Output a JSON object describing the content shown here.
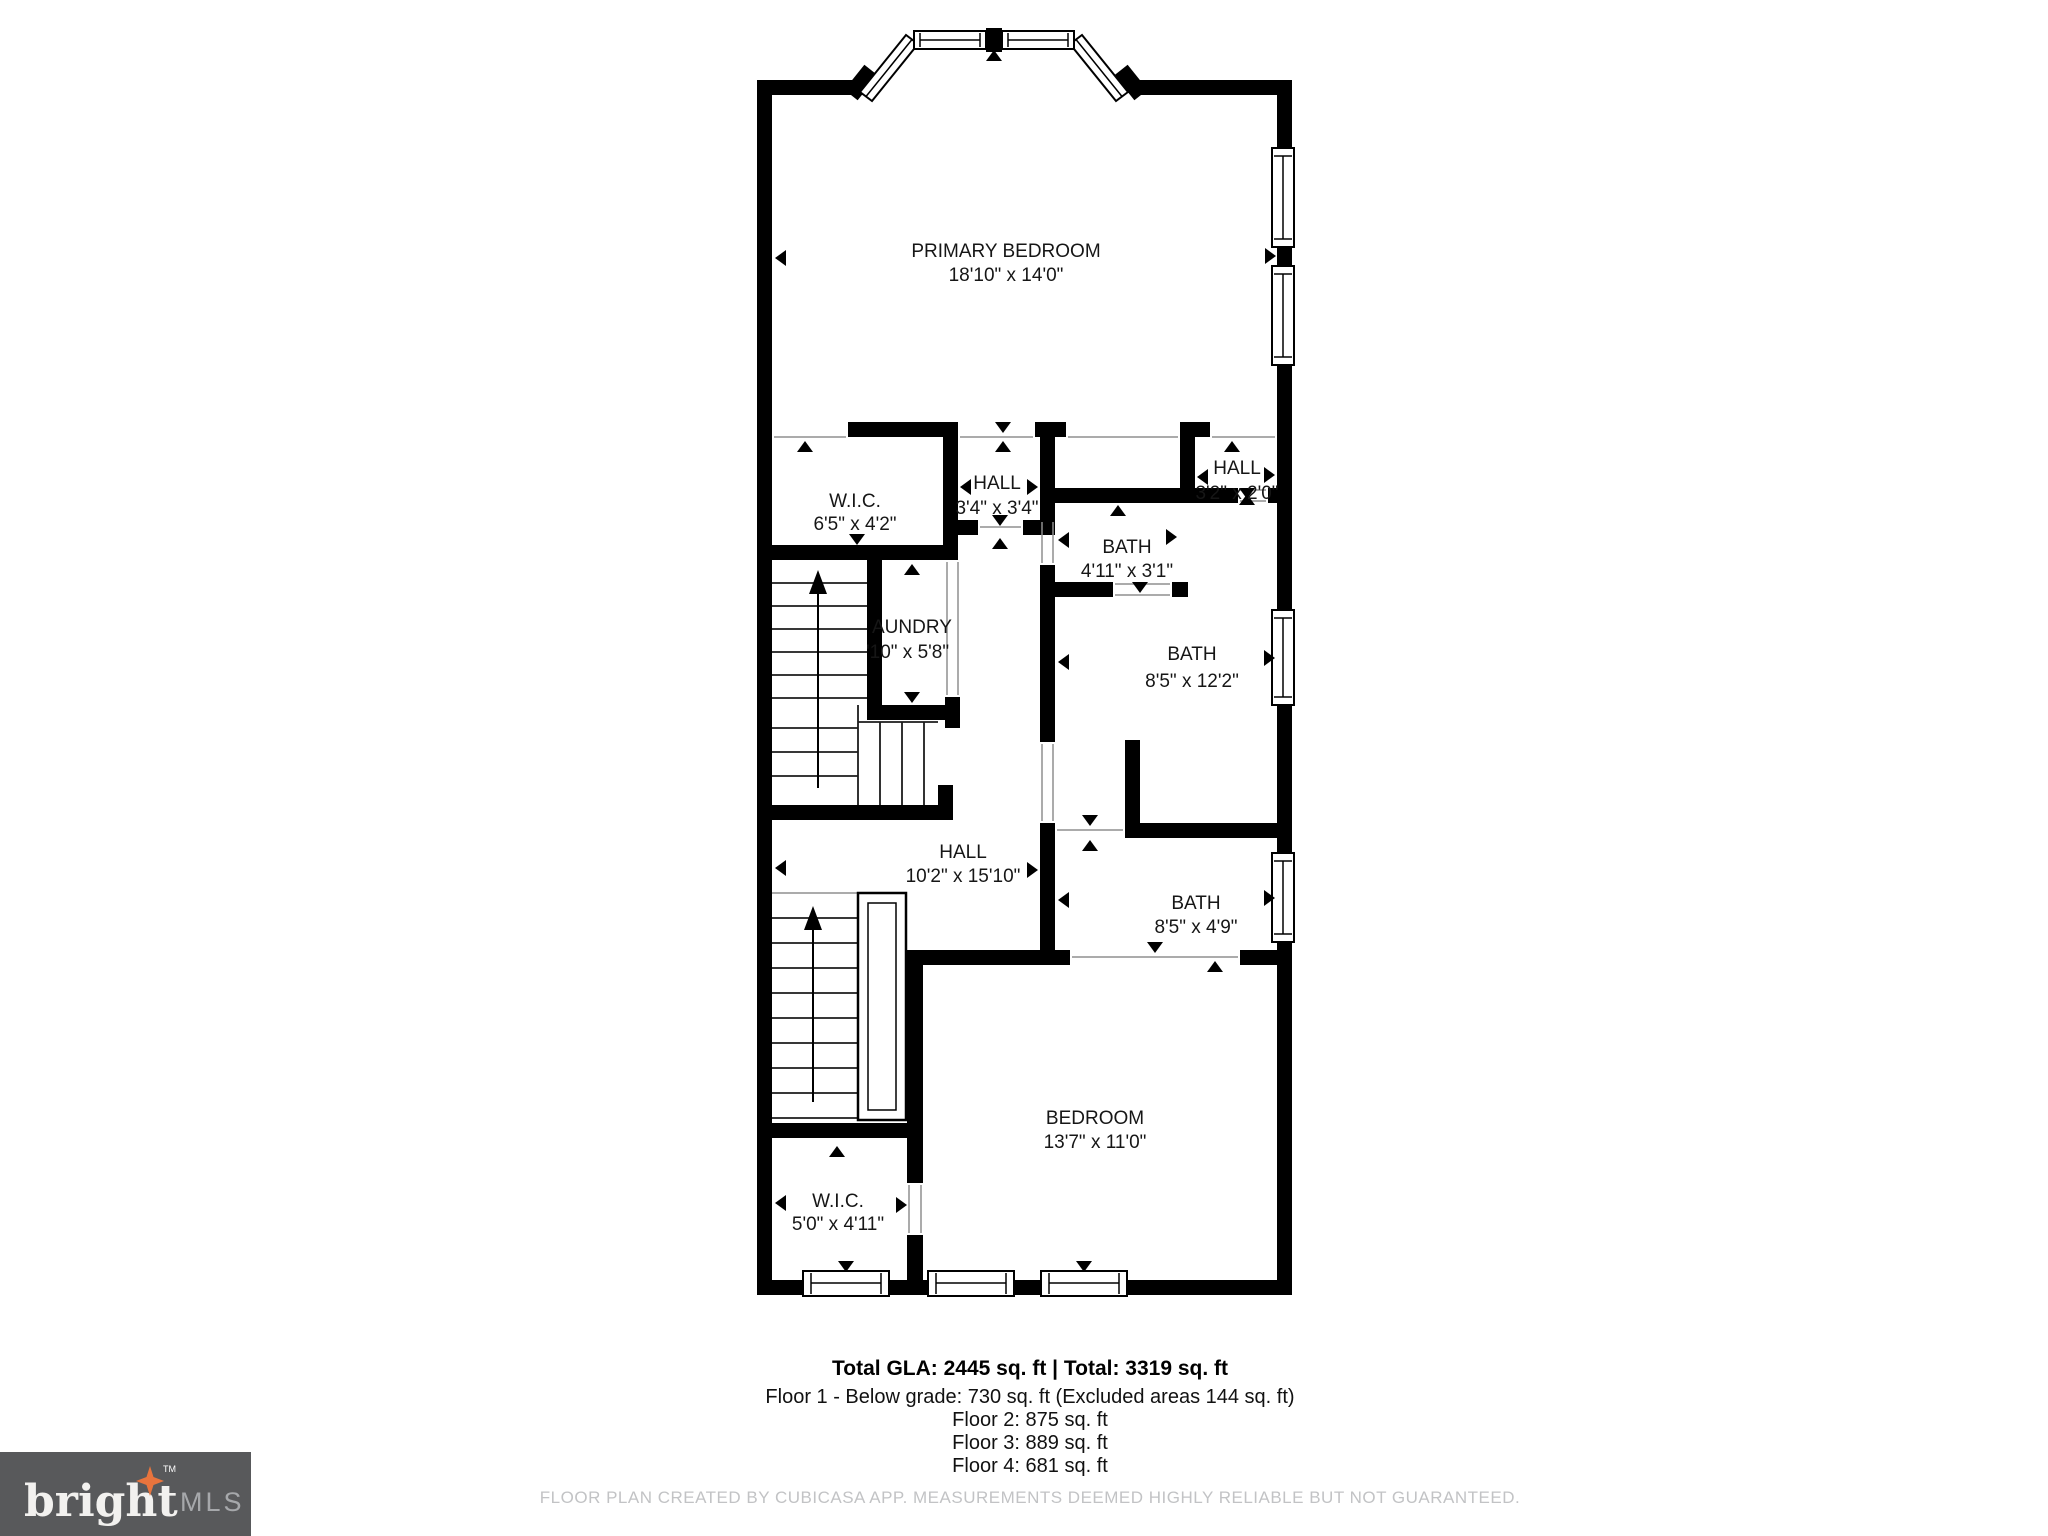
{
  "plan": {
    "rooms": {
      "primary_bedroom": {
        "name": "PRIMARY BEDROOM",
        "dims": "18'10\" x 14'0\""
      },
      "wic_upper": {
        "name": "W.I.C.",
        "dims": "6'5\" x 4'2\""
      },
      "hall_upper": {
        "name": "HALL",
        "dims": "3'4\" x 3'4\""
      },
      "hall_right": {
        "name": "HALL",
        "dims": "3'2\" x 2'0\""
      },
      "bath_wc": {
        "name": "BATH",
        "dims": "4'11\" x 3'1\""
      },
      "bath_primary": {
        "name": "BATH",
        "dims": "8'5\" x 12'2\""
      },
      "laundry": {
        "name": "AUNDRY",
        "dims": "'10\" x 5'8\""
      },
      "hall_main": {
        "name": "HALL",
        "dims": "10'2\" x 15'10\""
      },
      "bath_hall": {
        "name": "BATH",
        "dims": "8'5\" x 4'9\""
      },
      "bedroom": {
        "name": "BEDROOM",
        "dims": "13'7\" x 11'0\""
      },
      "wic_lower": {
        "name": "W.I.C.",
        "dims": "5'0\" x 4'11\""
      }
    }
  },
  "summary": {
    "total": "Total GLA: 2445 sq. ft | Total: 3319 sq. ft",
    "floor1": "Floor 1 - Below grade: 730 sq. ft (Excluded areas 144 sq. ft)",
    "floor2": "Floor 2: 875 sq. ft",
    "floor3": "Floor 3: 889 sq. ft",
    "floor4": "Floor 4: 681 sq. ft"
  },
  "disclaimer": "FLOOR PLAN CREATED BY CUBICASA APP. MEASUREMENTS DEEMED HIGHLY RELIABLE BUT NOT GUARANTEED.",
  "logo": {
    "brand": "bright",
    "tm": "TM",
    "suffix": "MLS"
  },
  "colors": {
    "wall": "#000000",
    "thin_line": "#8f8f8f",
    "disclaimer_text": "#c2c3c5",
    "logo_background": "#58595b",
    "logo_star": "#e8743d",
    "logo_mls_text": "#a6a8ab"
  }
}
